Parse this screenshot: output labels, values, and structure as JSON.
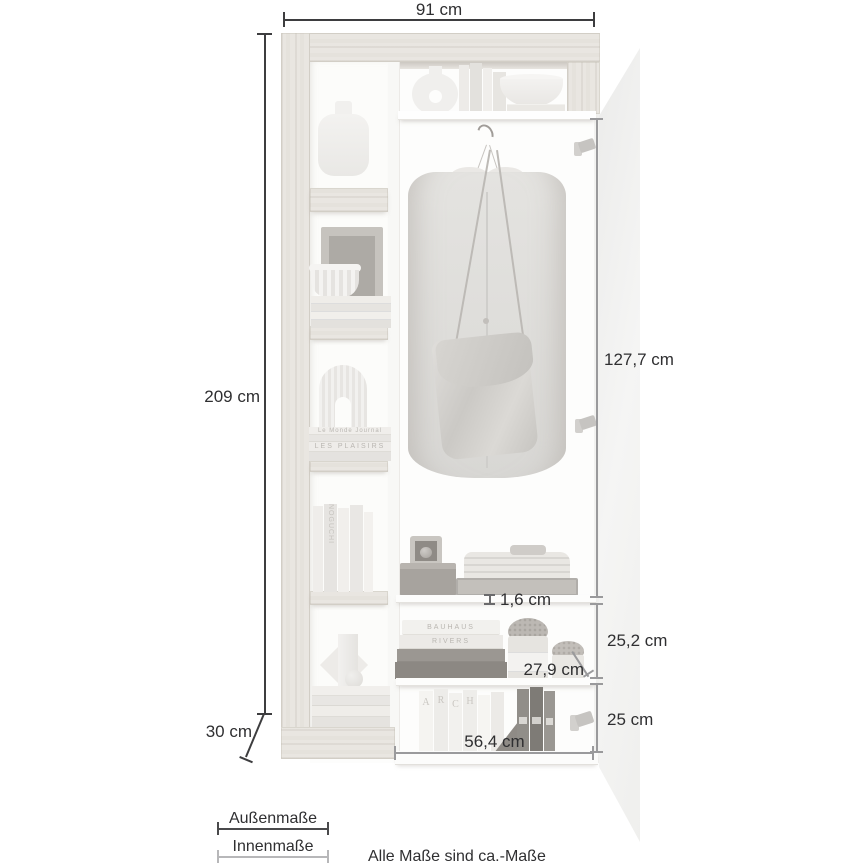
{
  "dimensions": {
    "outer_width": "91 cm",
    "outer_height": "209 cm",
    "outer_depth": "30 cm",
    "inner_door_height": "127,7 cm",
    "shelf_thickness": "1,6 cm",
    "middle_shelf_height": "25,2 cm",
    "inner_depth": "27,9 cm",
    "bottom_shelf_height": "25 cm",
    "inner_width": "56,4 cm"
  },
  "legend": {
    "outer_label": "Außenmaße",
    "inner_label": "Innenmaße",
    "note": "Alle Maße sind ca.-Maße"
  },
  "decor": {
    "book_stack_subtitle": "Le Monde Journal",
    "book_stack_title": "LES PLAISIRS",
    "book_spine_vertical": "NOGUCHI",
    "book_top_mid": "BAUHAUS",
    "book_mid": "RIVERS",
    "folder_letters": [
      "A",
      "R",
      "C",
      "H"
    ]
  },
  "colors": {
    "outer_dimension": "#3d3d3f",
    "inner_dimension": "#9a9a9c",
    "wood": "#e9e6e1",
    "interior": "#fdfdfc"
  }
}
